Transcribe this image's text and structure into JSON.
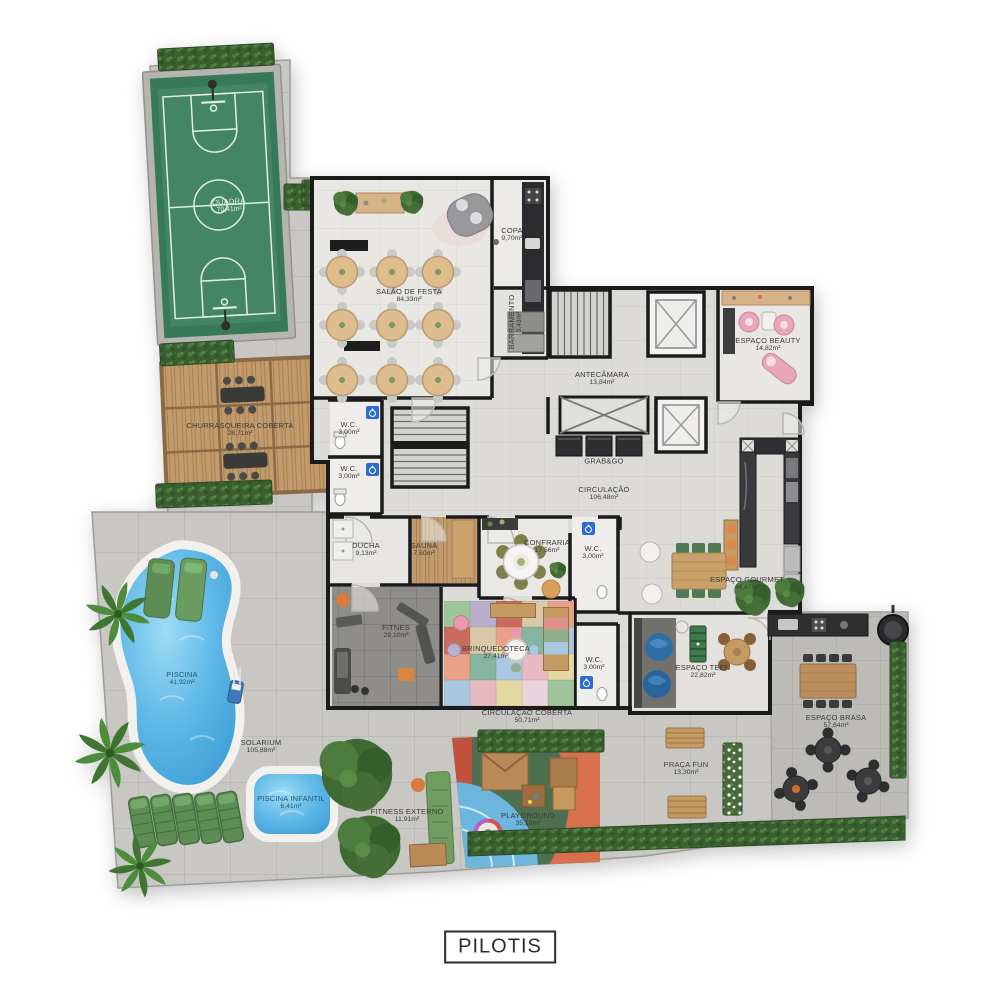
{
  "plan_title": "PILOTIS",
  "labels": {
    "quadra": {
      "name": "QUADRA",
      "area": "70,41m²"
    },
    "churrasqueira": {
      "name": "CHURRASQUEIRA COBERTA",
      "area": "28,71m²"
    },
    "salao": {
      "name": "SALÃO DE FESTA",
      "area": "84,33m²"
    },
    "copa": {
      "name": "COPA",
      "area": "9,70m²"
    },
    "barramento": {
      "name": "BARRAMENTO",
      "area": "3,43m²"
    },
    "antecamara": {
      "name": "ANTECÂMARA",
      "area": "13,84m²"
    },
    "beauty": {
      "name": "ESPAÇO BEAUTY",
      "area": "14,82m²"
    },
    "grabgo": {
      "name": "GRAB&GO",
      "area": ""
    },
    "circulacao": {
      "name": "CIRCULAÇÃO",
      "area": "106,48m²"
    },
    "wc_a": {
      "name": "W.C.",
      "area": "3,00m²"
    },
    "wc_b": {
      "name": "W.C.",
      "area": "3,00m²"
    },
    "wc_c": {
      "name": "W.C.",
      "area": "3,00m²"
    },
    "wc_d": {
      "name": "W.C.",
      "area": "3,00m²"
    },
    "ducha": {
      "name": "DUCHA",
      "area": "9,13m²"
    },
    "sauna": {
      "name": "SAUNA",
      "area": "7,60m²"
    },
    "confraria": {
      "name": "CONFRARIA",
      "area": "17,56m²"
    },
    "gourmet": {
      "name": "ESPAÇO GOURMET",
      "area": "44,47m²"
    },
    "fitnes": {
      "name": "FITNES",
      "area": "29,10m²"
    },
    "brinquedoteca": {
      "name": "BRINQUEDOTECA",
      "area": "27,41m²"
    },
    "teen": {
      "name": "ESPAÇO TEEN",
      "area": "22,82m²"
    },
    "circ_coberta": {
      "name": "CIRCULAÇÃO COBERTA",
      "area": "50,71m²"
    },
    "brasa": {
      "name": "ESPAÇO BRASA",
      "area": "57,64m²"
    },
    "piscina": {
      "name": "PISCINA",
      "area": "41,92m²"
    },
    "solarium": {
      "name": "SOLARIUM",
      "area": "105,88m²"
    },
    "piscina_infantil": {
      "name": "PISCINA INFANTIL",
      "area": "6,41m²"
    },
    "fitness_externo": {
      "name": "FITNESS EXTERNO",
      "area": "11,91m²"
    },
    "playground": {
      "name": "PLAYGROUND",
      "area": "35,10m²"
    },
    "praca_fun": {
      "name": "PRAÇA FUN",
      "area": "13,30m²"
    }
  },
  "colors": {
    "wall": "#1b1b1b",
    "court_green": "#38795b",
    "pool_blue": "#55b0e2",
    "deck_wood": "#c29b6c",
    "hedge_green": "#3a5f30",
    "beauty_pink": "#e9a6ba",
    "teen_blue": "#2f6fa8",
    "playground_green": "#4e7050",
    "playground_orange": "#d8704d",
    "brinquedoteca_palette": [
      "#9ec49a",
      "#e9b9c2",
      "#e8a087",
      "#b9aecb",
      "#e4d9a0",
      "#85b5a1",
      "#c96b5e",
      "#ead3dc",
      "#a9c7df",
      "#d8c8a8"
    ]
  }
}
